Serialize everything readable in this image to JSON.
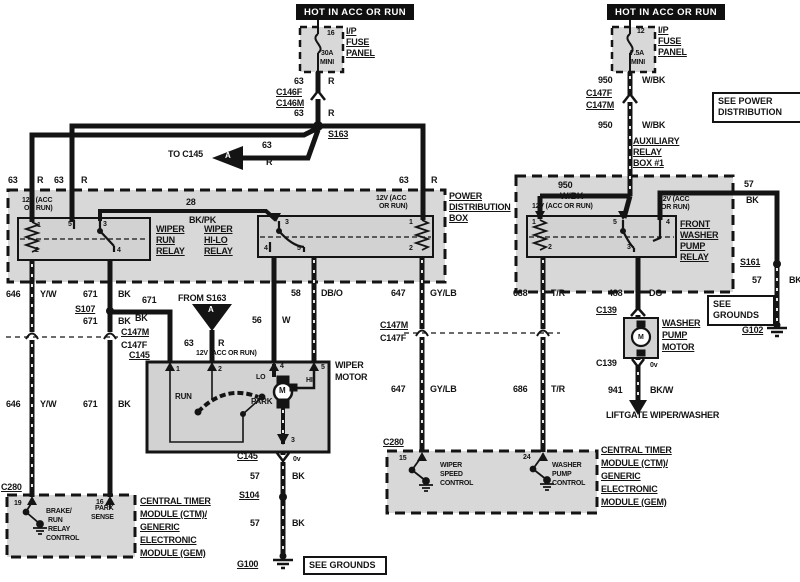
{
  "page": {
    "paper": "#ffffff",
    "ink": "#141414",
    "shade": "#d8d8d8"
  },
  "header_boxes": {
    "left": "HOT IN ACC OR RUN",
    "right": "HOT IN ACC OR RUN"
  },
  "note_boxes": {
    "see_power_distribution": "SEE POWER DISTRIBUTION",
    "see_grounds_right": "SEE GROUNDS",
    "see_grounds_bottom": "SEE GROUNDS"
  },
  "labels": [
    {
      "n": "fuse-left-pin",
      "t": "16",
      "x": 327,
      "y": 30,
      "s": 7
    },
    {
      "n": "fuse-left-rating",
      "t": "30A",
      "x": 321,
      "y": 50,
      "s": 7
    },
    {
      "n": "fuse-left-type",
      "t": "MINI",
      "x": 320,
      "y": 59,
      "s": 7
    },
    {
      "n": "fuse-left-name-1",
      "t": "I/P",
      "x": 346,
      "y": 27,
      "u": 1
    },
    {
      "n": "fuse-left-name-2",
      "t": "FUSE",
      "x": 346,
      "y": 38,
      "u": 1
    },
    {
      "n": "fuse-left-name-3",
      "t": "PANEL",
      "x": 346,
      "y": 49,
      "u": 1
    },
    {
      "n": "wire63-a-num",
      "t": "63",
      "x": 294,
      "y": 77
    },
    {
      "n": "wire63-a-col",
      "t": "R",
      "x": 328,
      "y": 77
    },
    {
      "n": "conn-c146f",
      "t": "C146F",
      "x": 276,
      "y": 88,
      "u": 1
    },
    {
      "n": "conn-c146m",
      "t": "C146M",
      "x": 276,
      "y": 99,
      "u": 1
    },
    {
      "n": "wire63-b-num",
      "t": "63",
      "x": 294,
      "y": 109
    },
    {
      "n": "wire63-b-col",
      "t": "R",
      "x": 328,
      "y": 109
    },
    {
      "n": "splice-s163",
      "t": "S163",
      "x": 328,
      "y": 130,
      "u": 1
    },
    {
      "n": "to-c145-note",
      "t": "TO C145",
      "x": 168,
      "y": 150
    },
    {
      "n": "triangle-a-left-letter",
      "t": "A",
      "x": 225,
      "y": 152,
      "s": 8,
      "w": 1
    },
    {
      "n": "wire63-c-num",
      "t": "63",
      "x": 262,
      "y": 141
    },
    {
      "n": "wire63-c-col",
      "t": "R",
      "x": 266,
      "y": 158
    },
    {
      "n": "wire63-d-num",
      "t": "63",
      "x": 8,
      "y": 176
    },
    {
      "n": "wire63-d-col",
      "t": "R",
      "x": 37,
      "y": 176
    },
    {
      "n": "wire63-e-num",
      "t": "63",
      "x": 54,
      "y": 176
    },
    {
      "n": "wire63-e-col",
      "t": "R",
      "x": 81,
      "y": 176
    },
    {
      "n": "wire63-f-num",
      "t": "63",
      "x": 399,
      "y": 176
    },
    {
      "n": "wire63-f-col",
      "t": "R",
      "x": 431,
      "y": 176
    },
    {
      "n": "power-dist-box-1",
      "t": "POWER",
      "x": 449,
      "y": 192,
      "u": 1
    },
    {
      "n": "power-dist-box-2",
      "t": "DISTRIBUTION",
      "x": 449,
      "y": 203,
      "u": 1
    },
    {
      "n": "power-dist-box-3",
      "t": "BOX",
      "x": 449,
      "y": 214,
      "u": 1
    },
    {
      "n": "run-relay-12v-1",
      "t": "12V (ACC",
      "x": 22,
      "y": 197,
      "s": 7
    },
    {
      "n": "run-relay-12v-2",
      "t": "OR RUN)",
      "x": 24,
      "y": 205,
      "s": 7
    },
    {
      "n": "wire28-num",
      "t": "28",
      "x": 186,
      "y": 198
    },
    {
      "n": "wire28-col",
      "t": "BK/PK",
      "x": 189,
      "y": 216
    },
    {
      "n": "wiper-run-relay-1",
      "t": "WIPER",
      "x": 156,
      "y": 225,
      "u": 1
    },
    {
      "n": "wiper-run-relay-2",
      "t": "RUN",
      "x": 156,
      "y": 236,
      "u": 1
    },
    {
      "n": "wiper-run-relay-3",
      "t": "RELAY",
      "x": 156,
      "y": 247,
      "u": 1
    },
    {
      "n": "wiper-hilo-relay-1",
      "t": "WIPER",
      "x": 204,
      "y": 225,
      "u": 1
    },
    {
      "n": "wiper-hilo-relay-2",
      "t": "HI-LO",
      "x": 204,
      "y": 236,
      "u": 1
    },
    {
      "n": "wiper-hilo-relay-3",
      "t": "RELAY",
      "x": 204,
      "y": 247,
      "u": 1
    },
    {
      "n": "run-relay-pin1",
      "t": "1",
      "x": 37,
      "y": 222,
      "s": 7
    },
    {
      "n": "run-relay-pin5",
      "t": "5",
      "x": 68,
      "y": 221,
      "s": 7
    },
    {
      "n": "run-relay-pin3",
      "t": "3",
      "x": 103,
      "y": 221,
      "s": 7
    },
    {
      "n": "run-relay-pin2",
      "t": "2",
      "x": 35,
      "y": 247,
      "s": 7
    },
    {
      "n": "run-relay-pin4",
      "t": "4",
      "x": 117,
      "y": 247,
      "s": 7
    },
    {
      "n": "hilo-relay-12v-1",
      "t": "12V (ACC",
      "x": 376,
      "y": 195,
      "s": 7
    },
    {
      "n": "hilo-relay-12v-2",
      "t": "OR RUN)",
      "x": 379,
      "y": 203,
      "s": 7
    },
    {
      "n": "hilo-relay-pin3",
      "t": "3",
      "x": 285,
      "y": 219,
      "s": 7
    },
    {
      "n": "hilo-relay-pin1",
      "t": "1",
      "x": 409,
      "y": 219,
      "s": 7
    },
    {
      "n": "hilo-relay-pin4",
      "t": "4",
      "x": 264,
      "y": 245,
      "s": 7
    },
    {
      "n": "hilo-relay-pin5",
      "t": "5",
      "x": 297,
      "y": 245,
      "s": 7
    },
    {
      "n": "hilo-relay-pin2",
      "t": "2",
      "x": 409,
      "y": 245,
      "s": 7
    },
    {
      "n": "wire646-a-num",
      "t": "646",
      "x": 6,
      "y": 290
    },
    {
      "n": "wire646-a-col",
      "t": "Y/W",
      "x": 40,
      "y": 290
    },
    {
      "n": "wire671-a-num",
      "t": "671",
      "x": 83,
      "y": 290
    },
    {
      "n": "wire671-a-col",
      "t": "BK",
      "x": 118,
      "y": 290
    },
    {
      "n": "splice-s107",
      "t": "S107",
      "x": 75,
      "y": 305,
      "u": 1
    },
    {
      "n": "wire671-b-num",
      "t": "671",
      "x": 142,
      "y": 296
    },
    {
      "n": "wire671-b-col",
      "t": "BK",
      "x": 135,
      "y": 314
    },
    {
      "n": "wire671-c-num",
      "t": "671",
      "x": 83,
      "y": 317
    },
    {
      "n": "wire671-c-col",
      "t": "BK",
      "x": 118,
      "y": 317
    },
    {
      "n": "conn-c147m-left",
      "t": "C147M",
      "x": 121,
      "y": 328,
      "u": 1
    },
    {
      "n": "conn-c147f-left",
      "t": "C147F",
      "x": 121,
      "y": 341
    },
    {
      "n": "conn-c145-left",
      "t": "C145",
      "x": 129,
      "y": 351,
      "u": 1
    },
    {
      "n": "wire646-b-num",
      "t": "646",
      "x": 6,
      "y": 400
    },
    {
      "n": "wire646-b-col",
      "t": "Y/W",
      "x": 40,
      "y": 400
    },
    {
      "n": "wire671-d-num",
      "t": "671",
      "x": 83,
      "y": 400
    },
    {
      "n": "wire671-d-col",
      "t": "BK",
      "x": 118,
      "y": 400
    },
    {
      "n": "from-s163-note",
      "t": "FROM S163",
      "x": 178,
      "y": 294
    },
    {
      "n": "triangle-a-down-letter",
      "t": "A",
      "x": 208,
      "y": 306,
      "s": 8,
      "w": 1
    },
    {
      "n": "wire63-g-num",
      "t": "63",
      "x": 184,
      "y": 339
    },
    {
      "n": "wire63-g-col",
      "t": "R",
      "x": 218,
      "y": 339
    },
    {
      "n": "motor-12v-note",
      "t": "12V (ACC OR RUN)",
      "x": 196,
      "y": 350,
      "s": 7
    },
    {
      "n": "wire56-num",
      "t": "56",
      "x": 252,
      "y": 316
    },
    {
      "n": "wire56-col",
      "t": "W",
      "x": 282,
      "y": 316
    },
    {
      "n": "wire58-num",
      "t": "58",
      "x": 291,
      "y": 289
    },
    {
      "n": "wire58-col",
      "t": "DB/O",
      "x": 321,
      "y": 289
    },
    {
      "n": "wiper-motor-1",
      "t": "WIPER",
      "x": 335,
      "y": 361
    },
    {
      "n": "wiper-motor-2",
      "t": "MOTOR",
      "x": 335,
      "y": 373
    },
    {
      "n": "motor-pin1",
      "t": "1",
      "x": 176,
      "y": 366,
      "s": 7
    },
    {
      "n": "motor-pin2",
      "t": "2",
      "x": 218,
      "y": 366,
      "s": 7
    },
    {
      "n": "motor-pin4",
      "t": "4",
      "x": 280,
      "y": 363,
      "s": 7
    },
    {
      "n": "motor-pin5",
      "t": "5",
      "x": 321,
      "y": 364,
      "s": 7
    },
    {
      "n": "motor-lo",
      "t": "LO",
      "x": 256,
      "y": 374,
      "s": 7
    },
    {
      "n": "motor-hi",
      "t": "HI",
      "x": 306,
      "y": 377,
      "s": 7
    },
    {
      "n": "motor-m-letter",
      "t": "M",
      "x": 279,
      "y": 387,
      "s": 8
    },
    {
      "n": "motor-run",
      "t": "RUN",
      "x": 175,
      "y": 393,
      "s": 8
    },
    {
      "n": "motor-park",
      "t": "PARK",
      "x": 251,
      "y": 398,
      "s": 8
    },
    {
      "n": "motor-pin3",
      "t": "3",
      "x": 291,
      "y": 437,
      "s": 7
    },
    {
      "n": "conn-c145-bottom",
      "t": "C145",
      "x": 237,
      "y": 452,
      "u": 1
    },
    {
      "n": "motor-0v",
      "t": "0v",
      "x": 293,
      "y": 456,
      "s": 7
    },
    {
      "n": "wire57-a-num",
      "t": "57",
      "x": 250,
      "y": 472
    },
    {
      "n": "wire57-a-col",
      "t": "BK",
      "x": 292,
      "y": 472
    },
    {
      "n": "splice-s104",
      "t": "S104",
      "x": 239,
      "y": 491,
      "u": 1
    },
    {
      "n": "wire57-b-num",
      "t": "57",
      "x": 250,
      "y": 519
    },
    {
      "n": "wire57-b-col",
      "t": "BK",
      "x": 292,
      "y": 519
    },
    {
      "n": "ground-g100",
      "t": "G100",
      "x": 237,
      "y": 560,
      "u": 1
    },
    {
      "n": "fuse-right-pin",
      "t": "12",
      "x": 637,
      "y": 28,
      "s": 7
    },
    {
      "n": "fuse-right-rating",
      "t": "7.5A",
      "x": 630,
      "y": 50,
      "s": 7
    },
    {
      "n": "fuse-right-type",
      "t": "MINI",
      "x": 631,
      "y": 59,
      "s": 7
    },
    {
      "n": "fuse-right-name-1",
      "t": "I/P",
      "x": 658,
      "y": 26,
      "u": 1
    },
    {
      "n": "fuse-right-name-2",
      "t": "FUSE",
      "x": 658,
      "y": 37,
      "u": 1
    },
    {
      "n": "fuse-right-name-3",
      "t": "PANEL",
      "x": 658,
      "y": 48,
      "u": 1
    },
    {
      "n": "wire950-a-num",
      "t": "950",
      "x": 598,
      "y": 76
    },
    {
      "n": "wire950-a-col",
      "t": "W/BK",
      "x": 642,
      "y": 76
    },
    {
      "n": "conn-c147f-right",
      "t": "C147F",
      "x": 586,
      "y": 89,
      "u": 1
    },
    {
      "n": "conn-c147m-right",
      "t": "C147M",
      "x": 586,
      "y": 101,
      "u": 1
    },
    {
      "n": "wire950-b-num",
      "t": "950",
      "x": 598,
      "y": 121
    },
    {
      "n": "wire950-b-col",
      "t": "W/BK",
      "x": 642,
      "y": 121
    },
    {
      "n": "aux-relay-box-1",
      "t": "AUXILIARY",
      "x": 633,
      "y": 137,
      "u": 1
    },
    {
      "n": "aux-relay-box-2",
      "t": "RELAY",
      "x": 633,
      "y": 148,
      "u": 1
    },
    {
      "n": "aux-relay-box-3",
      "t": "BOX #1",
      "x": 633,
      "y": 159,
      "u": 1
    },
    {
      "n": "wire950-c-num",
      "t": "950",
      "x": 558,
      "y": 181
    },
    {
      "n": "wire950-c-col",
      "t": "W/BK",
      "x": 560,
      "y": 192
    },
    {
      "n": "aux-relay-12v-a",
      "t": "12V (ACC OR RUN)",
      "x": 532,
      "y": 203,
      "s": 7
    },
    {
      "n": "aux-relay-12v-b1",
      "t": "12V (ACC",
      "x": 659,
      "y": 196,
      "s": 7
    },
    {
      "n": "aux-relay-12v-b2",
      "t": "OR RUN)",
      "x": 661,
      "y": 204,
      "s": 7
    },
    {
      "n": "washer-relay-1",
      "t": "FRONT",
      "x": 680,
      "y": 220,
      "u": 1
    },
    {
      "n": "washer-relay-2",
      "t": "WASHER",
      "x": 680,
      "y": 231,
      "u": 1
    },
    {
      "n": "washer-relay-3",
      "t": "PUMP",
      "x": 680,
      "y": 242,
      "u": 1
    },
    {
      "n": "washer-relay-4",
      "t": "RELAY",
      "x": 680,
      "y": 253,
      "u": 1
    },
    {
      "n": "aux-relay-pin1",
      "t": "1",
      "x": 532,
      "y": 219,
      "s": 7
    },
    {
      "n": "aux-relay-pin5",
      "t": "5",
      "x": 613,
      "y": 219,
      "s": 7
    },
    {
      "n": "aux-relay-pin4",
      "t": "4",
      "x": 666,
      "y": 219,
      "s": 7
    },
    {
      "n": "aux-relay-pin2",
      "t": "2",
      "x": 548,
      "y": 244,
      "s": 7
    },
    {
      "n": "aux-relay-pin3",
      "t": "3",
      "x": 627,
      "y": 244,
      "s": 7
    },
    {
      "n": "wire57-c-num",
      "t": "57",
      "x": 744,
      "y": 180
    },
    {
      "n": "wire57-c-col",
      "t": "BK",
      "x": 746,
      "y": 196
    },
    {
      "n": "splice-s161",
      "t": "S161",
      "x": 740,
      "y": 258,
      "u": 1
    },
    {
      "n": "wire57-d-num",
      "t": "57",
      "x": 752,
      "y": 276
    },
    {
      "n": "wire57-d-col",
      "t": "BK",
      "x": 789,
      "y": 276
    },
    {
      "n": "ground-g102",
      "t": "G102",
      "x": 742,
      "y": 326,
      "u": 1
    },
    {
      "n": "wire488-num",
      "t": "488",
      "x": 608,
      "y": 289
    },
    {
      "n": "wire488-col",
      "t": "DG",
      "x": 649,
      "y": 289
    },
    {
      "n": "conn-c139-top",
      "t": "C139",
      "x": 596,
      "y": 306,
      "u": 1
    },
    {
      "n": "washer-pump-motor-1",
      "t": "WASHER",
      "x": 662,
      "y": 319,
      "u": 1
    },
    {
      "n": "washer-pump-motor-2",
      "t": "PUMP",
      "x": 662,
      "y": 331,
      "u": 1
    },
    {
      "n": "washer-pump-motor-3",
      "t": "MOTOR",
      "x": 662,
      "y": 343,
      "u": 1
    },
    {
      "n": "washer-motor-m-letter",
      "t": "M",
      "x": 638,
      "y": 334,
      "s": 7
    },
    {
      "n": "conn-c139-bottom",
      "t": "C139",
      "x": 596,
      "y": 359
    },
    {
      "n": "washer-0v",
      "t": "0v",
      "x": 650,
      "y": 362,
      "s": 7
    },
    {
      "n": "wire941-num",
      "t": "941",
      "x": 608,
      "y": 386
    },
    {
      "n": "wire941-col",
      "t": "BK/W",
      "x": 650,
      "y": 386
    },
    {
      "n": "liftgate-note",
      "t": "LIFTGATE WIPER/WASHER",
      "x": 606,
      "y": 411
    },
    {
      "n": "wire688-num",
      "t": "688",
      "x": 513,
      "y": 289
    },
    {
      "n": "wire688-col",
      "t": "T/R",
      "x": 551,
      "y": 289
    },
    {
      "n": "wire686-num",
      "t": "686",
      "x": 513,
      "y": 385
    },
    {
      "n": "wire686-col",
      "t": "T/R",
      "x": 551,
      "y": 385
    },
    {
      "n": "conn-c147m-mid",
      "t": "C147M",
      "x": 380,
      "y": 321,
      "u": 1
    },
    {
      "n": "conn-c147f-mid",
      "t": "C147F",
      "x": 380,
      "y": 334
    },
    {
      "n": "wire647-a-num",
      "t": "647",
      "x": 391,
      "y": 289
    },
    {
      "n": "wire647-a-col",
      "t": "GY/LB",
      "x": 430,
      "y": 289
    },
    {
      "n": "wire647-b-num",
      "t": "647",
      "x": 391,
      "y": 385
    },
    {
      "n": "wire647-b-col",
      "t": "GY/LB",
      "x": 430,
      "y": 385
    },
    {
      "n": "conn-c280-mid",
      "t": "C280",
      "x": 383,
      "y": 438,
      "u": 1
    },
    {
      "n": "ctm-mid-pin15",
      "t": "15",
      "x": 399,
      "y": 455,
      "s": 7
    },
    {
      "n": "ctm-mid-pin24",
      "t": "24",
      "x": 523,
      "y": 454,
      "s": 7
    },
    {
      "n": "wiper-speed-control-1",
      "t": "WIPER",
      "x": 440,
      "y": 462,
      "s": 7
    },
    {
      "n": "wiper-speed-control-2",
      "t": "SPEED",
      "x": 440,
      "y": 471,
      "s": 7
    },
    {
      "n": "wiper-speed-control-3",
      "t": "CONTROL",
      "x": 440,
      "y": 480,
      "s": 7
    },
    {
      "n": "washer-pump-control-1",
      "t": "WASHER",
      "x": 552,
      "y": 462,
      "s": 7
    },
    {
      "n": "washer-pump-control-2",
      "t": "PUMP",
      "x": 552,
      "y": 471,
      "s": 7
    },
    {
      "n": "washer-pump-control-3",
      "t": "CONTROL",
      "x": 552,
      "y": 480,
      "s": 7
    },
    {
      "n": "ctm-mid-name-1",
      "t": "CENTRAL TIMER",
      "x": 601,
      "y": 446,
      "u": 1
    },
    {
      "n": "ctm-mid-name-2",
      "t": "MODULE (CTM)/",
      "x": 601,
      "y": 459,
      "u": 1
    },
    {
      "n": "ctm-mid-name-3",
      "t": "GENERIC",
      "x": 601,
      "y": 472,
      "u": 1
    },
    {
      "n": "ctm-mid-name-4",
      "t": "ELECTRONIC",
      "x": 601,
      "y": 485,
      "u": 1
    },
    {
      "n": "ctm-mid-name-5",
      "t": "MODULE (GEM)",
      "x": 601,
      "y": 498,
      "u": 1
    },
    {
      "n": "conn-c280-left",
      "t": "C280",
      "x": 1,
      "y": 483,
      "u": 1
    },
    {
      "n": "ctm-left-pin19",
      "t": "19",
      "x": 14,
      "y": 500,
      "s": 7
    },
    {
      "n": "ctm-left-pin16",
      "t": "16",
      "x": 96,
      "y": 499,
      "s": 7
    },
    {
      "n": "brake-run-relay-1",
      "t": "BRAKE/",
      "x": 46,
      "y": 508,
      "s": 7
    },
    {
      "n": "brake-run-relay-2",
      "t": "RUN",
      "x": 48,
      "y": 517,
      "s": 7
    },
    {
      "n": "brake-run-relay-3",
      "t": "RELAY",
      "x": 48,
      "y": 526,
      "s": 7
    },
    {
      "n": "brake-run-relay-4",
      "t": "CONTROL",
      "x": 46,
      "y": 535,
      "s": 7
    },
    {
      "n": "park-sense-1",
      "t": "PARK",
      "x": 95,
      "y": 505,
      "s": 7
    },
    {
      "n": "park-sense-2",
      "t": "SENSE",
      "x": 91,
      "y": 514,
      "s": 7
    },
    {
      "n": "ctm-left-name-1",
      "t": "CENTRAL TIMER",
      "x": 140,
      "y": 497,
      "u": 1
    },
    {
      "n": "ctm-left-name-2",
      "t": "MODULE (CTM)/",
      "x": 140,
      "y": 510,
      "u": 1
    },
    {
      "n": "ctm-left-name-3",
      "t": "GENERIC",
      "x": 140,
      "y": 523,
      "u": 1
    },
    {
      "n": "ctm-left-name-4",
      "t": "ELECTRONIC",
      "x": 140,
      "y": 536,
      "u": 1
    },
    {
      "n": "ctm-left-name-5",
      "t": "MODULE (GEM)",
      "x": 140,
      "y": 549,
      "u": 1
    }
  ]
}
